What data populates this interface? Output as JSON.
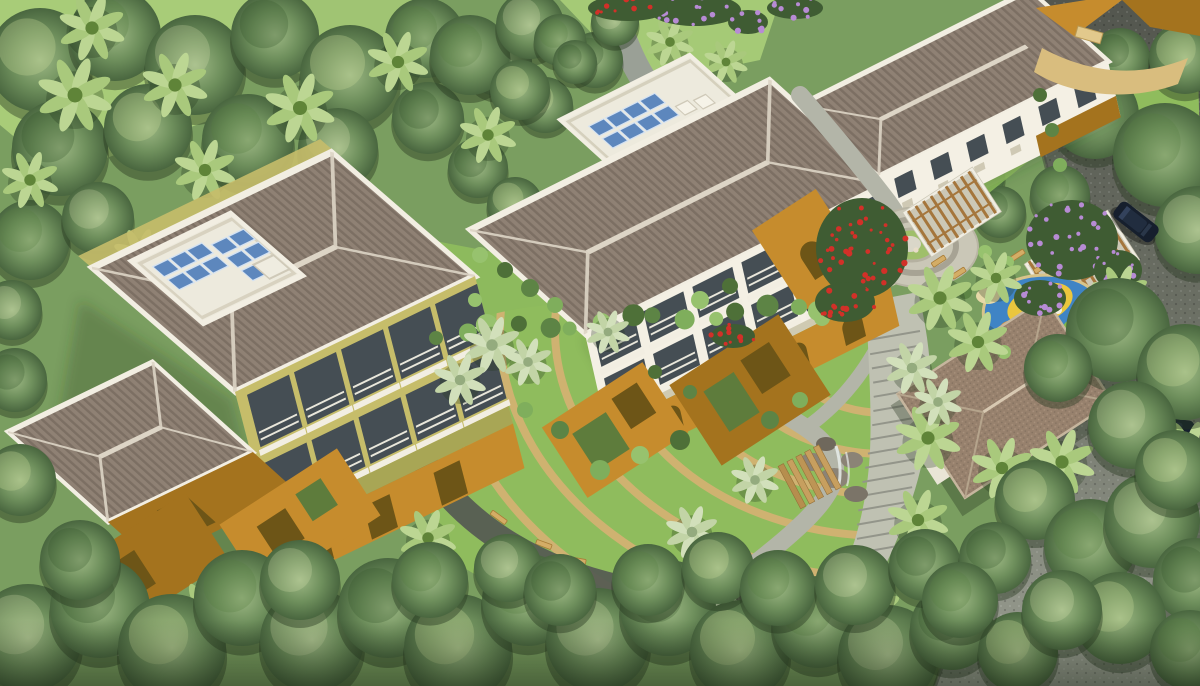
{
  "scene": {
    "type": "aerial-architectural-render",
    "description": "Daytime aerial 3D rendering of a low-rise apartment complex surrounded by dense tropical trees, with a landscaped central courtyard of curved lawn seating bands, winding pebble paths, a circular plaza with pergolas, a children's playground, a hip-roofed garden pavilion, a rock water feature and an internal road with two dark cars.",
    "buildings": [
      {
        "id": "block-a",
        "label": "Left apartment block",
        "details": "Hip tiled roof, rooftop terrace with solar panels, tiered balconies, ochre courtyard walls"
      },
      {
        "id": "block-b",
        "label": "Central apartment block",
        "details": "Hip tiled roof, balcony facade, arched ochre courtyard walls"
      },
      {
        "id": "block-c",
        "label": "Upper apartment block (partially visible)",
        "details": "Hip tiled roof, white facade with windows"
      }
    ],
    "amenities": [
      {
        "id": "central-lawn",
        "label": "Central lawn with concentric seating bands and benches"
      },
      {
        "id": "plaza",
        "label": "Circular paved plaza with spiral path"
      },
      {
        "id": "pergolas",
        "label": "Timber pergolas with benches"
      },
      {
        "id": "playground",
        "label": "Children's play area with colored safety surfacing"
      },
      {
        "id": "pavilion",
        "label": "Hip-roofed garden pavilion with steps"
      },
      {
        "id": "water-feature",
        "label": "Rock cascade with timber steps"
      },
      {
        "id": "paths",
        "label": "Pebble walkway and stepped concrete path"
      },
      {
        "id": "road",
        "label": "Internal asphalt road"
      },
      {
        "id": "gate",
        "label": "Entrance gateway walls"
      }
    ],
    "vehicles": [
      {
        "id": "car-1",
        "label": "Dark car on road near entrance"
      },
      {
        "id": "car-2",
        "label": "Dark car parked under tree beside road"
      }
    ],
    "vegetation": [
      "dense sage-green tree canopy",
      "coconut palms",
      "banana plants",
      "clipped shrub borders",
      "red bougainvillea beds",
      "purple flowering trees"
    ]
  },
  "palette": {
    "ground": "#7a9e60",
    "lawn": "#8fbc5d",
    "lawn_light": "#b0d47c",
    "band": "#d3b272",
    "canopy": "#6e8f5c",
    "canopy_light": "#9db884",
    "canopy_dark": "#49663f",
    "palm": "#8fb657",
    "banana": "#c2d4a6",
    "roof": "#8f8174",
    "roof_stripe": "#7c6f63",
    "roof_ridge": "#ddd5c6",
    "eave": "#f2eee2",
    "terrace": "#edeadd",
    "solar": "#5d87bd",
    "facade": "#f4f0e4",
    "wall_yellow": "#c6bd6a",
    "wall_olive": "#a8a655",
    "balcony": "#454e54",
    "railing": "#e9e7db",
    "orange": "#c68c2d",
    "orange_dark": "#a4731e",
    "opening": "#6d5517",
    "road": "#5c6057",
    "road_light": "#989c90",
    "stone": "#b3b5a8",
    "stone_dark": "#565c52",
    "concrete": "#bfc1b2",
    "plaza": "#cac7b7",
    "plaza_ring": "#a7a394",
    "play_blue": "#3f84c5",
    "play_yellow": "#eac63e",
    "play_green": "#7cb84a",
    "play_orange": "#e2922f",
    "pavilion": "#97816d",
    "wood": "#a5763c",
    "bench": "#d4ad66",
    "flower_red": "#d23028",
    "flower_purple": "#b78bd4",
    "car": "#161f2d",
    "glass": "#33425c",
    "rock": "#8b8376",
    "water": "#e8edea"
  }
}
